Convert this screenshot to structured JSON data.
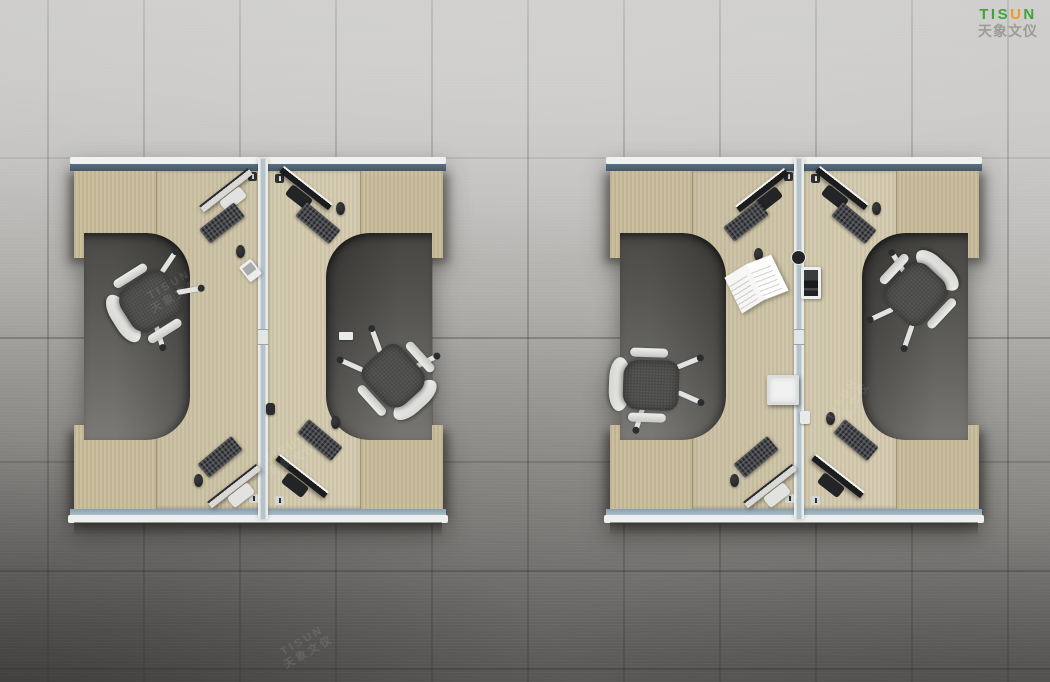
{
  "meta": {
    "type": "product-photo",
    "description": "Top-down 3D render of two I-beam shaped four-person office workstation clusters with wood desktops, privacy screens and task chairs on a concrete tile floor"
  },
  "logo": {
    "en": "TISUN",
    "en_part1": "TIS",
    "en_part2": "U",
    "en_part3": "N",
    "cn": "天象文仪",
    "green": "#3fa33c",
    "orange": "#f29a1d",
    "cn_color": "#94928c"
  },
  "watermark": {
    "en": "TISUN",
    "cn": "天象文仪"
  },
  "scene": {
    "clusters": 2,
    "desks_per_cluster": 2,
    "chairs_per_cluster": 2,
    "monitors_per_cluster": 4,
    "keyboards_per_cluster": 4,
    "props": [
      "open magazine",
      "desk phone",
      "white storage box",
      "divider-mounted screen"
    ],
    "colors": {
      "desk_wood": "#cdc3a7",
      "cabinet_wood": "#c8bc9c",
      "rail_white": "#f0f2f1",
      "rail_blue_top": "#4e6274",
      "rail_blue_bottom": "#a3b6c1",
      "divider_core": "#b7c3ca",
      "floor_light": "#cecdcb",
      "floor_dark": "#565452",
      "chair_seat": "#4b4b49",
      "chair_shell": "#e9e9e7",
      "monitor_black": "#1b1c1e",
      "monitor_silver": "#d9d9d7"
    }
  }
}
